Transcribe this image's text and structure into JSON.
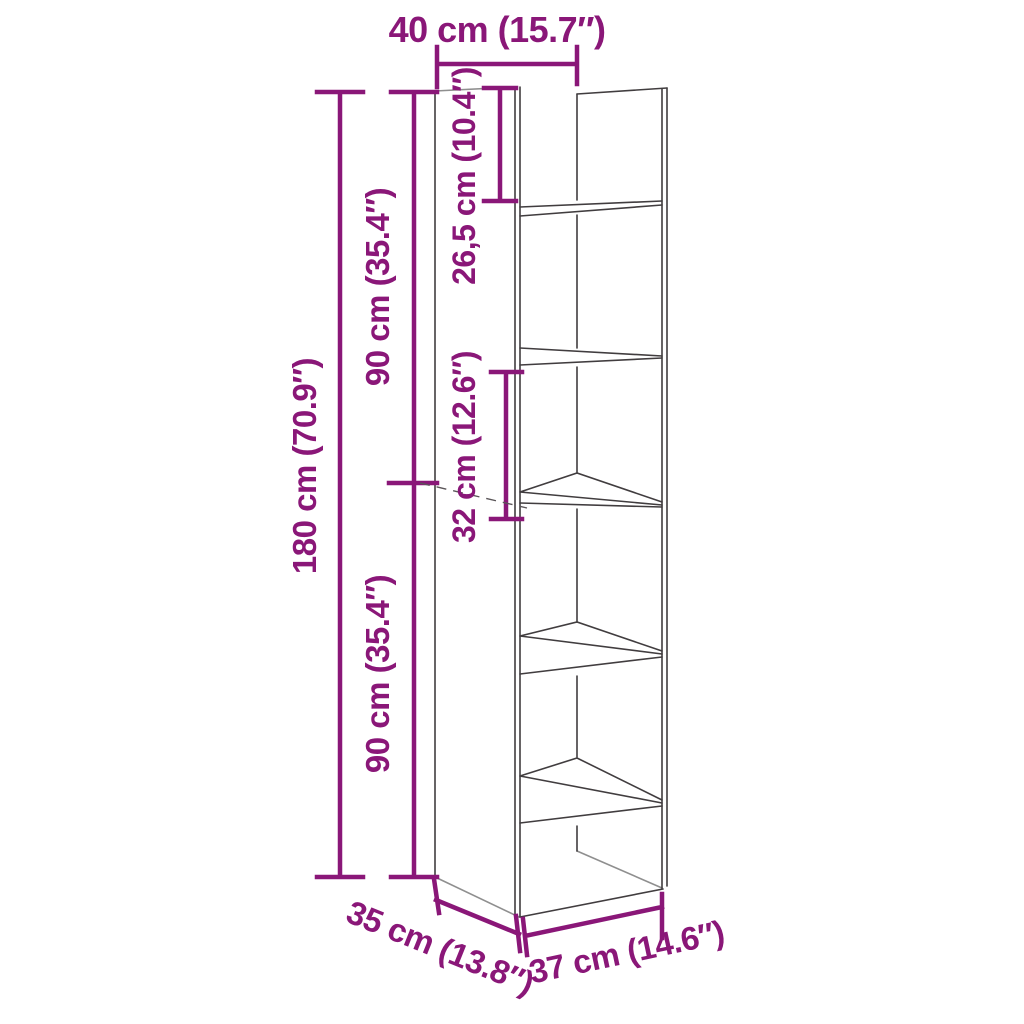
{
  "diagram": {
    "subject": "bookshelf-dimension-drawing",
    "colors": {
      "dimension_accent": "#8a1778",
      "outline_dark": "#413d3f",
      "outline_light": "#8f8f8f",
      "background": "#ffffff"
    },
    "dimensions": {
      "top_width": {
        "label": "40 cm (15.7″)",
        "value_cm": "40",
        "value_in": "15.7"
      },
      "total_height": {
        "label": "180 cm (70.9″)",
        "value_cm": "180",
        "value_in": "70.9"
      },
      "upper_section_height": {
        "label": "90 cm (35.4″)",
        "value_cm": "90",
        "value_in": "35.4"
      },
      "lower_section_height": {
        "label": "90 cm (35.4″)",
        "value_cm": "90",
        "value_in": "35.4"
      },
      "top_compartment_height": {
        "label": "26,5 cm (10.4″)",
        "value_cm": "26,5",
        "value_in": "10.4"
      },
      "middle_compartment_height": {
        "label": "32 cm (12.6″)",
        "value_cm": "32",
        "value_in": "12.6"
      },
      "depth": {
        "label": "35 cm (13.8″)",
        "value_cm": "35",
        "value_in": "13.8"
      },
      "bottom_width": {
        "label": "37 cm (14.6″)",
        "value_cm": "37",
        "value_in": "14.6"
      }
    }
  }
}
